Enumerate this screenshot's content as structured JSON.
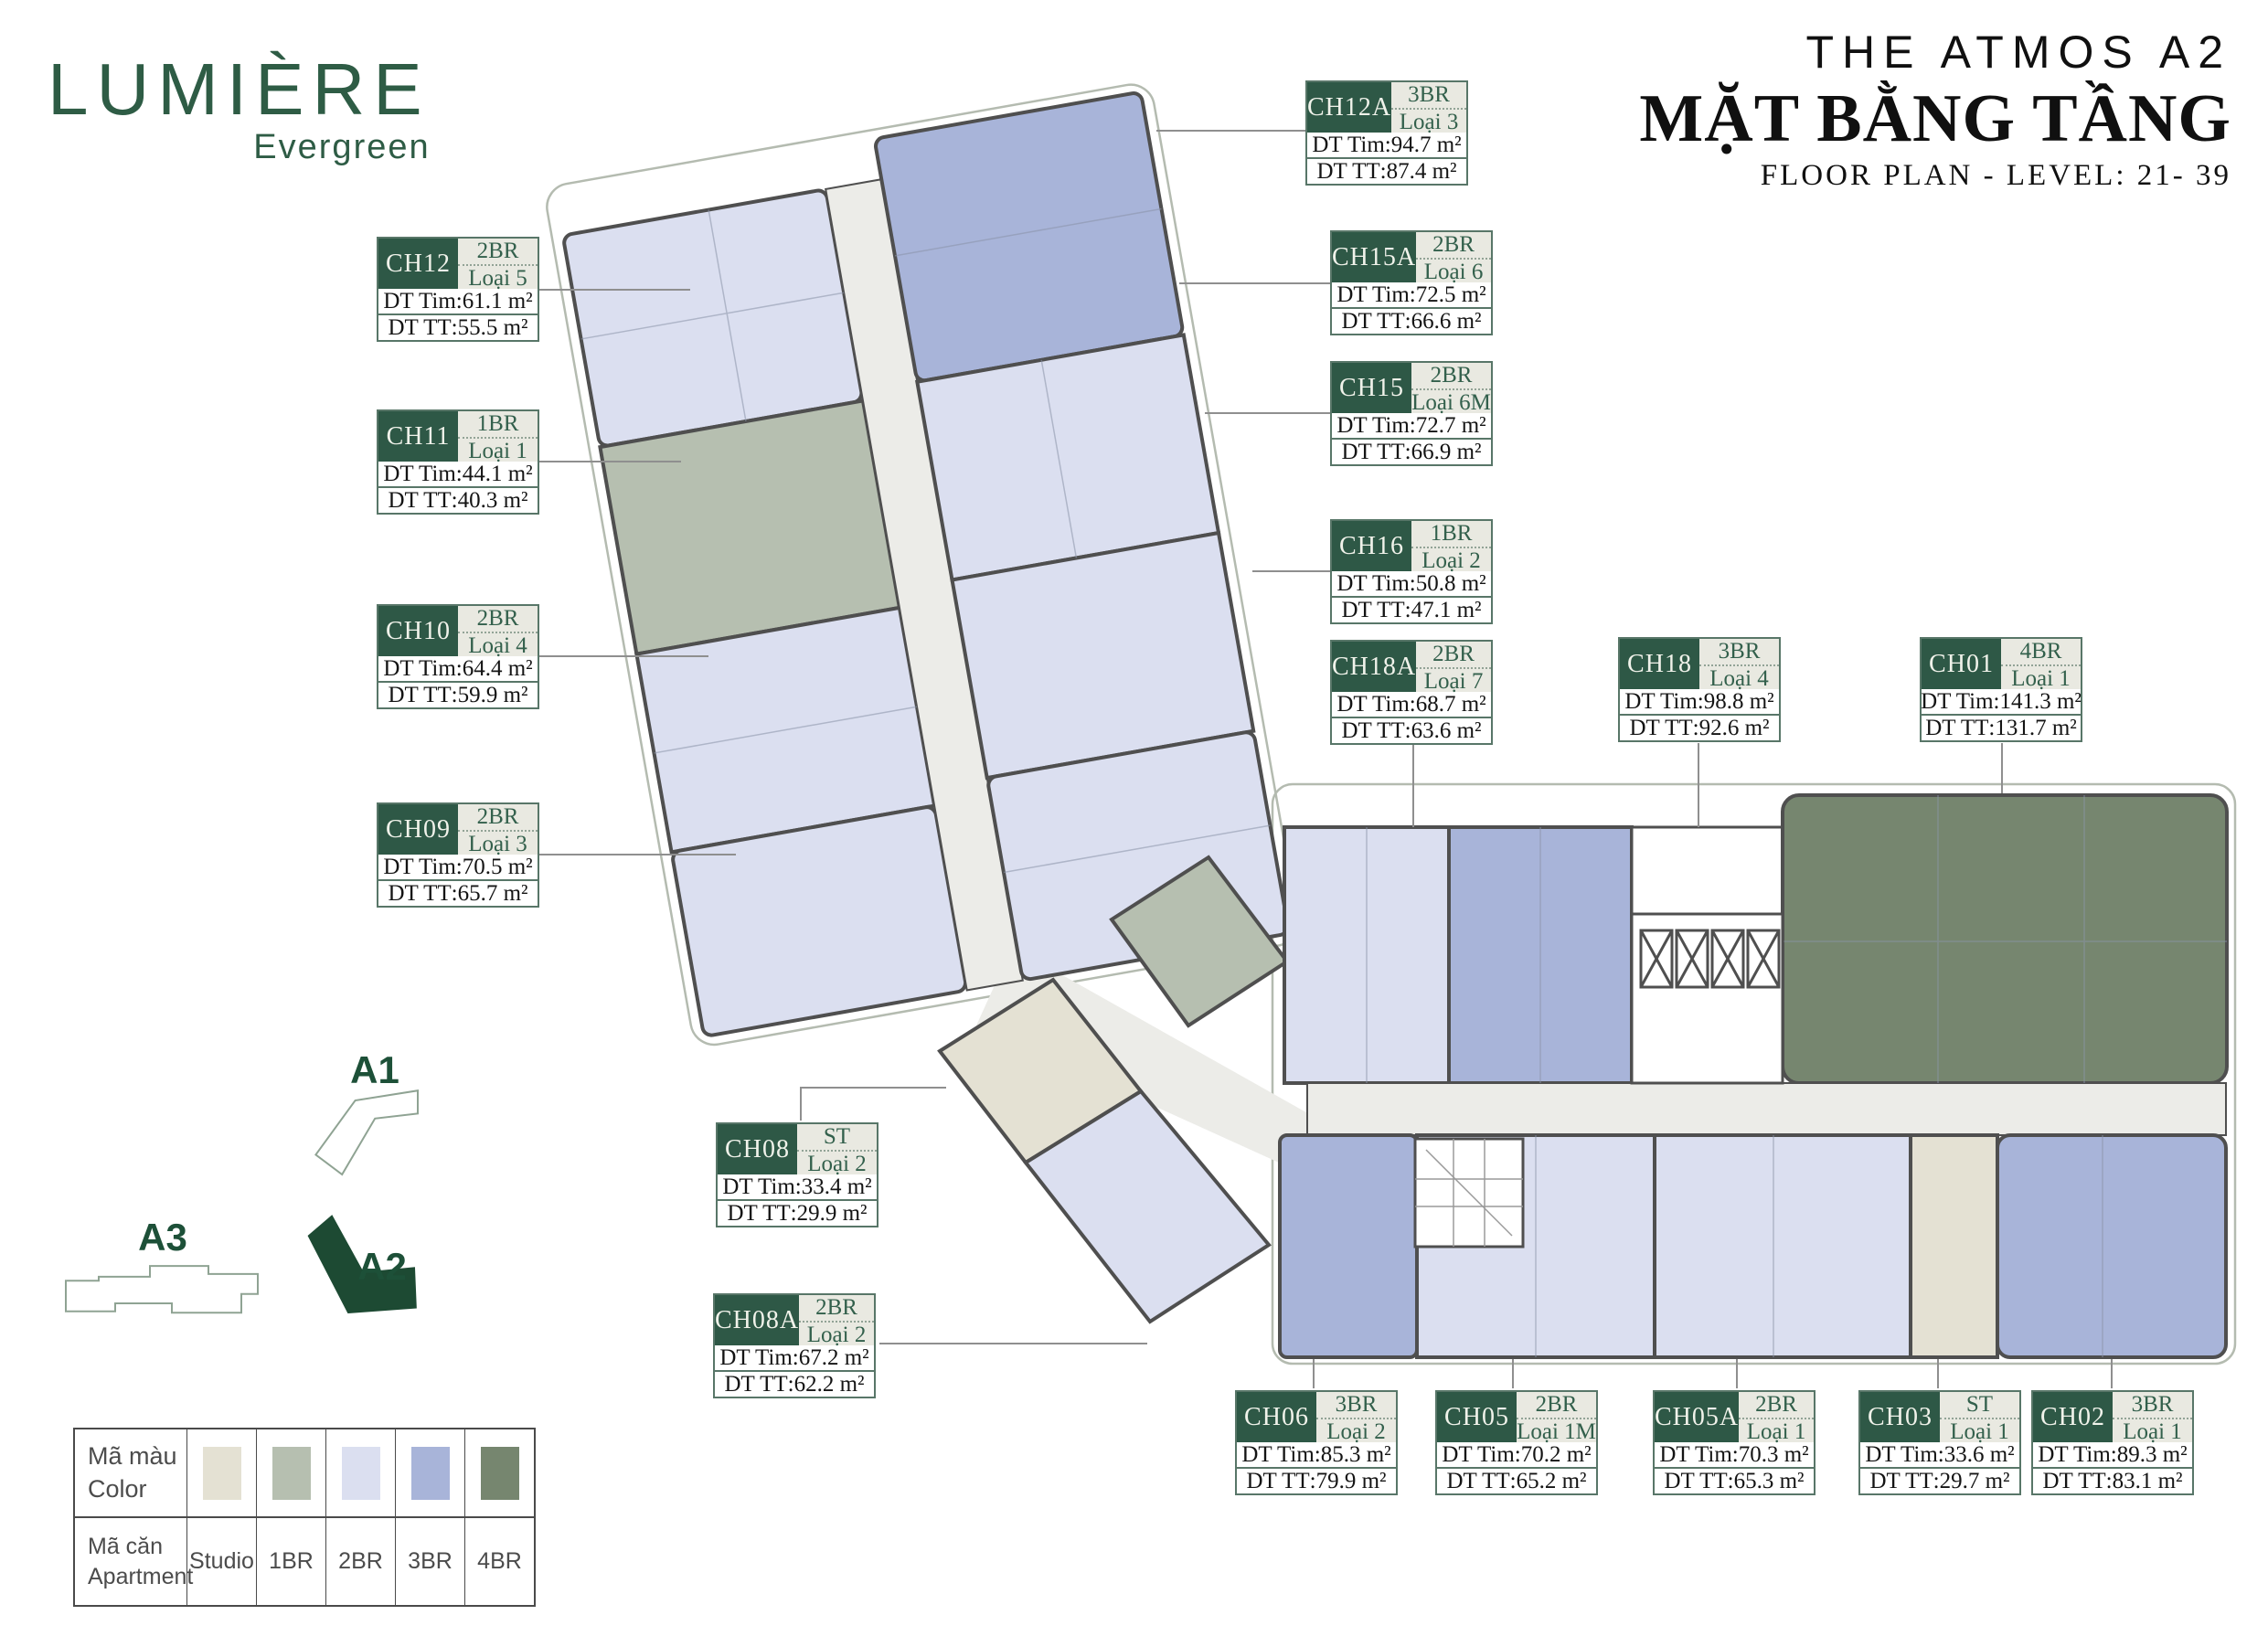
{
  "brand": {
    "name": "LUMIÈRE",
    "tagline": "Evergreen"
  },
  "header": {
    "project": "THE ATMOS A2",
    "title_vi": "MẶT BẰNG TẦNG",
    "subtitle": "FLOOR PLAN - LEVEL: 21- 39"
  },
  "labels": {
    "dt_tim": "DT Tim",
    "dt_tt": "DT TT"
  },
  "units": [
    {
      "code": "CH12A",
      "type": "3BR",
      "variant": "Loại 3",
      "dt_tim": "94.7 m²",
      "dt_tt": "87.4 m²"
    },
    {
      "code": "CH15A",
      "type": "2BR",
      "variant": "Loại 6",
      "dt_tim": "72.5 m²",
      "dt_tt": "66.6 m²"
    },
    {
      "code": "CH15",
      "type": "2BR",
      "variant": "Loại 6M",
      "dt_tim": "72.7 m²",
      "dt_tt": "66.9 m²"
    },
    {
      "code": "CH16",
      "type": "1BR",
      "variant": "Loại 2",
      "dt_tim": "50.8 m²",
      "dt_tt": "47.1 m²"
    },
    {
      "code": "CH18A",
      "type": "2BR",
      "variant": "Loại 7",
      "dt_tim": "68.7 m²",
      "dt_tt": "63.6 m²"
    },
    {
      "code": "CH18",
      "type": "3BR",
      "variant": "Loại 4",
      "dt_tim": "98.8 m²",
      "dt_tt": "92.6 m²"
    },
    {
      "code": "CH01",
      "type": "4BR",
      "variant": "Loại 1",
      "dt_tim": "141.3 m²",
      "dt_tt": "131.7 m²"
    },
    {
      "code": "CH12",
      "type": "2BR",
      "variant": "Loại 5",
      "dt_tim": "61.1 m²",
      "dt_tt": "55.5 m²"
    },
    {
      "code": "CH11",
      "type": "1BR",
      "variant": "Loại 1",
      "dt_tim": "44.1 m²",
      "dt_tt": "40.3 m²"
    },
    {
      "code": "CH10",
      "type": "2BR",
      "variant": "Loại 4",
      "dt_tim": "64.4 m²",
      "dt_tt": "59.9 m²"
    },
    {
      "code": "CH09",
      "type": "2BR",
      "variant": "Loại 3",
      "dt_tim": "70.5 m²",
      "dt_tt": "65.7 m²"
    },
    {
      "code": "CH08",
      "type": "ST",
      "variant": "Loại 2",
      "dt_tim": "33.4 m²",
      "dt_tt": "29.9 m²"
    },
    {
      "code": "CH08A",
      "type": "2BR",
      "variant": "Loại 2",
      "dt_tim": "67.2 m²",
      "dt_tt": "62.2 m²"
    },
    {
      "code": "CH06",
      "type": "3BR",
      "variant": "Loại 2",
      "dt_tim": "85.3 m²",
      "dt_tt": "79.9 m²"
    },
    {
      "code": "CH05",
      "type": "2BR",
      "variant": "Loại 1M",
      "dt_tim": "70.2 m²",
      "dt_tt": "65.2 m²"
    },
    {
      "code": "CH05A",
      "type": "2BR",
      "variant": "Loại 1",
      "dt_tim": "70.3 m²",
      "dt_tt": "65.3 m²"
    },
    {
      "code": "CH03",
      "type": "ST",
      "variant": "Loại 1",
      "dt_tim": "33.6 m²",
      "dt_tt": "29.7 m²"
    },
    {
      "code": "CH02",
      "type": "3BR",
      "variant": "Loại 1",
      "dt_tim": "89.3 m²",
      "dt_tt": "83.1 m²"
    }
  ],
  "site_plan": {
    "buildings": [
      {
        "label": "A1",
        "highlighted": false
      },
      {
        "label": "A2",
        "highlighted": true
      },
      {
        "label": "A3",
        "highlighted": false
      }
    ]
  },
  "legend": {
    "color_row": {
      "vi": "Mã màu",
      "en": "Color"
    },
    "apartment_row": {
      "vi": "Mã căn",
      "en": "Apartment"
    },
    "items": [
      {
        "label": "Studio",
        "color": "#E4E1D3"
      },
      {
        "label": "1BR",
        "color": "#B6BFB0"
      },
      {
        "label": "2BR",
        "color": "#DBDFF0"
      },
      {
        "label": "3BR",
        "color": "#A8B4D9"
      },
      {
        "label": "4BR",
        "color": "#76866F"
      }
    ]
  },
  "colors": {
    "brand_green": "#2E5C45",
    "card_header_green": "#2E5846",
    "site_active_green": "#1D4A33",
    "wall": "#4F4F4F",
    "corridor": "#ECECE8"
  }
}
